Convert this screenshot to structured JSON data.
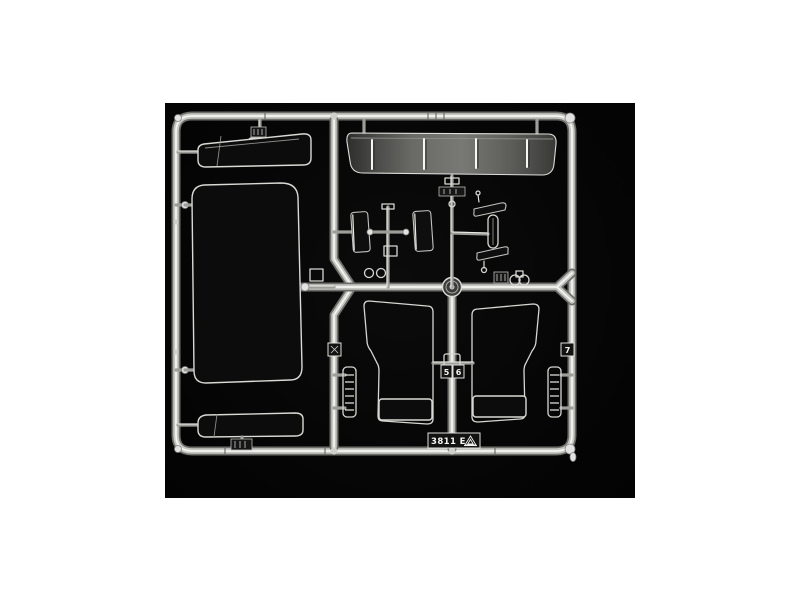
{
  "photo": {
    "alt": "Clear transparent plastic parts sprue (windows, sun visor, mirrors) of a model kit photographed on a black background",
    "canvas_background": "#ffffff",
    "photo_background": "#070707",
    "plastic_highlight": "#f4f4f0",
    "part_outline": "#d9d9d5"
  },
  "markings": {
    "mold_code": "3811 E",
    "gate_number_7": "7",
    "gate_number_5": "5",
    "gate_number_6": "6"
  }
}
